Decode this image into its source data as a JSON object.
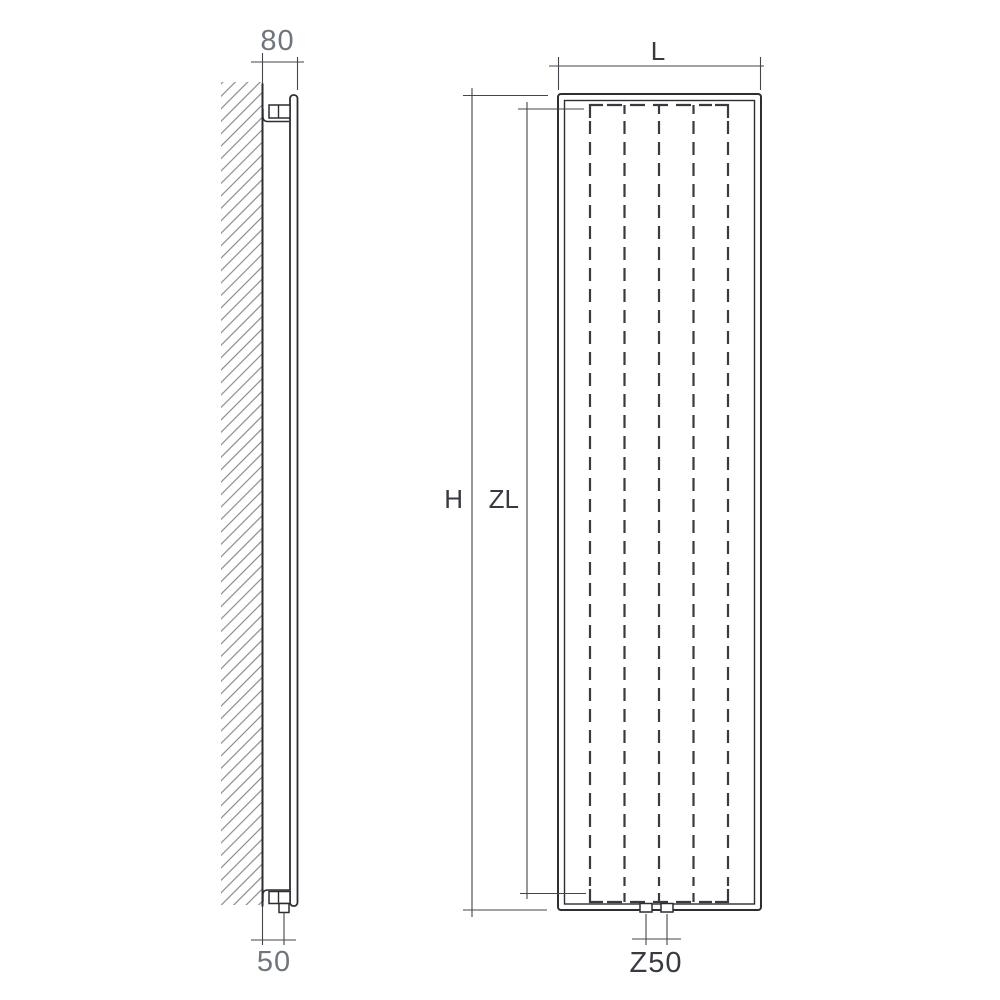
{
  "drawing": {
    "side_view": {
      "wall_offset_label": "80",
      "connection_offset_label": "50"
    },
    "front_view": {
      "width_label": "L",
      "overall_height_label": "H",
      "element_height_label": "ZL",
      "connection_spacing_label": "Z50"
    },
    "colors": {
      "object_line": "#2d2d32",
      "dimension_line": "#45454b",
      "hidden_line": "#3a3a40",
      "hatch_line": "#85878c",
      "label_light": "#6f747e",
      "label_dark": "#383a42",
      "background": "#ffffff"
    }
  }
}
